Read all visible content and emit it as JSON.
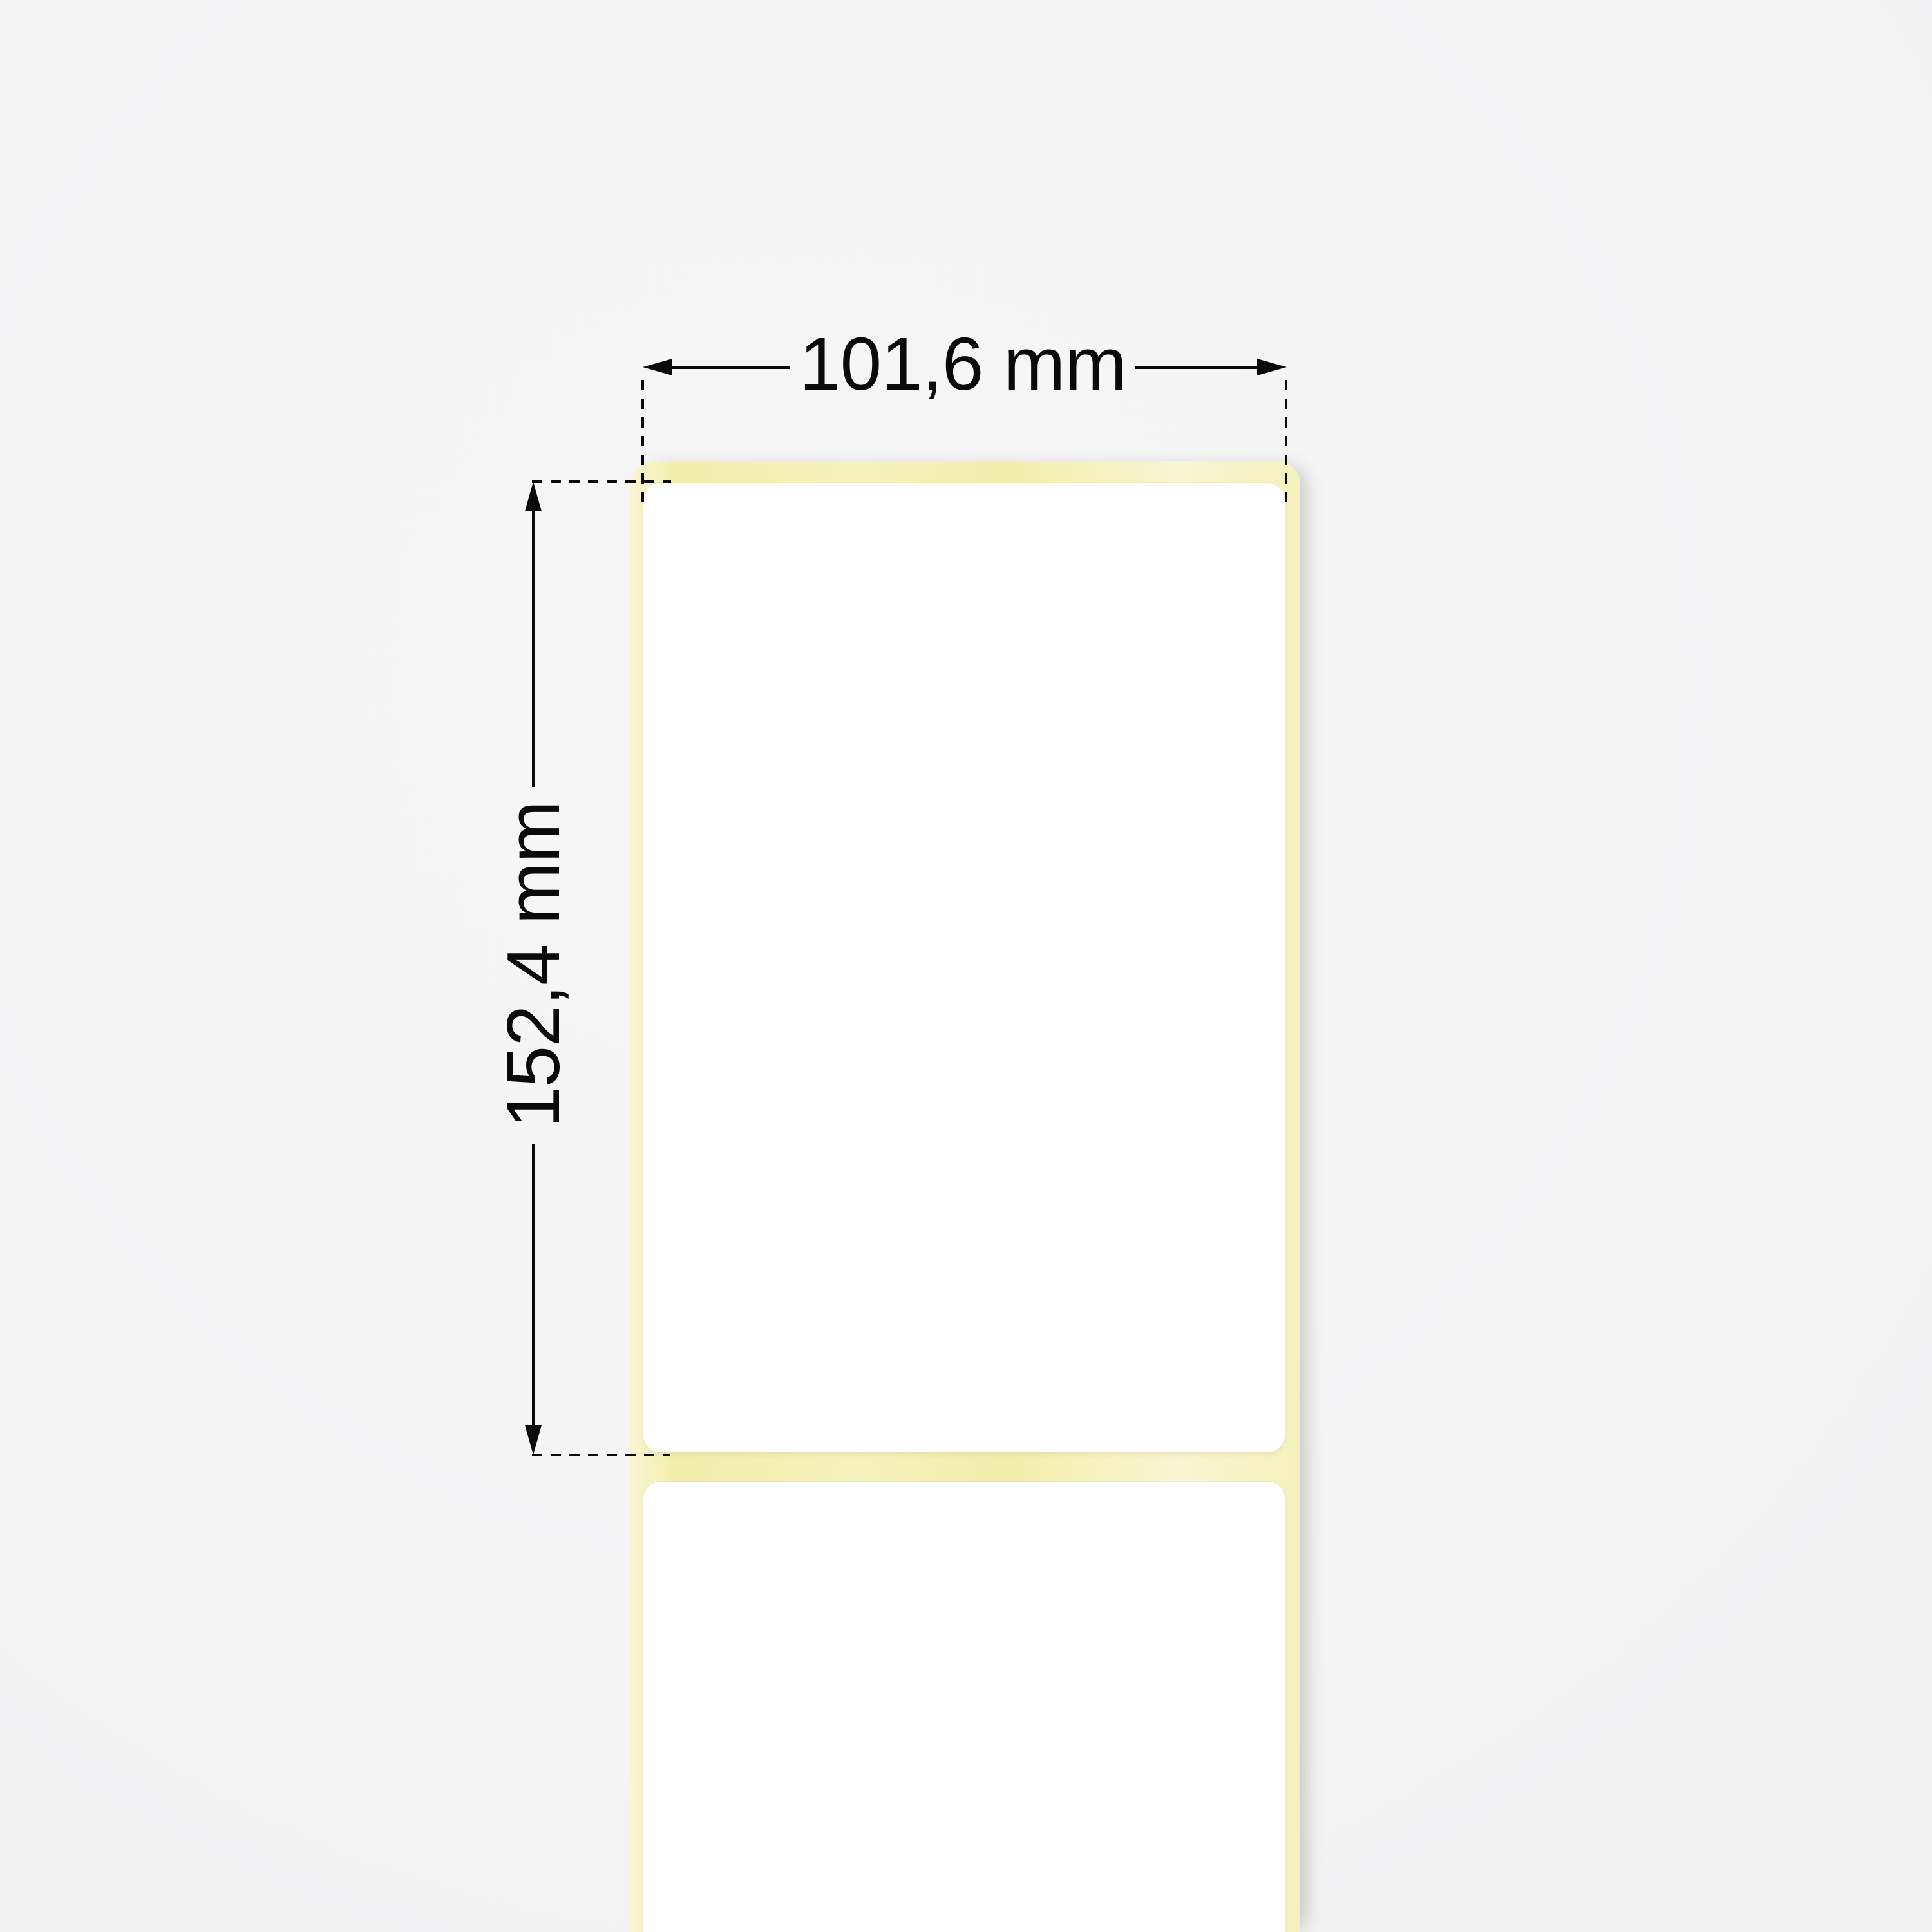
{
  "annotations": {
    "width_dimension": {
      "label": "101,6 mm"
    },
    "height_dimension": {
      "label": "152,4 mm"
    }
  },
  "colors": {
    "background": "#f5f5f6",
    "liner-yellow": "#f5f1bd",
    "liner-yellow-light": "#f8f5d2",
    "liner-yellow-deep": "#f2eeab",
    "label-white": "#ffffff",
    "annotation-ink": "#0a0a0a"
  }
}
